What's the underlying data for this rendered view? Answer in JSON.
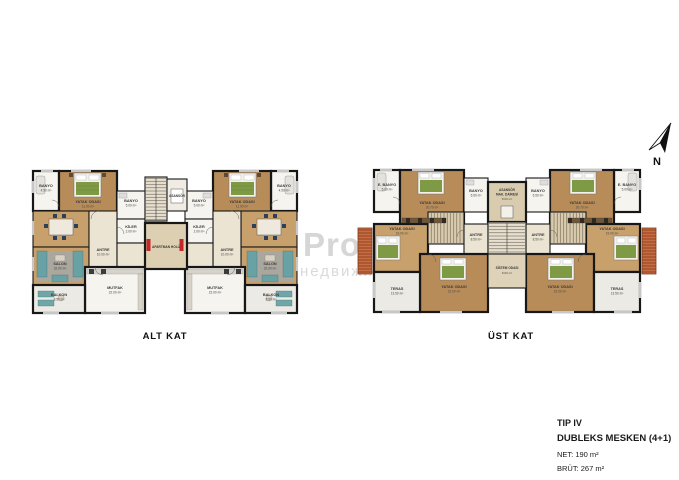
{
  "compass": {
    "label": "N"
  },
  "watermark": {
    "line1": "Pro",
    "line2": "недвижи"
  },
  "floors": {
    "alt": {
      "caption": "ALT KAT",
      "rooms": {
        "banyo_kucuk": {
          "name": "BANYO",
          "area": "4.50 m²"
        },
        "yatak": {
          "name": "YATAK ODASI",
          "area": "11.00 m²"
        },
        "banyo": {
          "name": "BANYO",
          "area": "5.00 m²"
        },
        "kiler": {
          "name": "KİLER",
          "area": "2.00 m²"
        },
        "antre": {
          "name": "ANTRE",
          "area": "10.00 m²"
        },
        "salon": {
          "name": "SALON",
          "area": "32.00 m²"
        },
        "mutfak": {
          "name": "MUTFAK",
          "area": "22.00 m²"
        },
        "balkon": {
          "name": "BALKON",
          "area": "8.50 m²"
        },
        "asansor": {
          "name": "ASANSÖR"
        },
        "hol": {
          "name": "APARTMAN HOLÜ"
        }
      }
    },
    "ust": {
      "caption": "ÜST KAT",
      "rooms": {
        "ebanyo": {
          "name": "E. BANYO",
          "area": "5.00 m²"
        },
        "yatak1": {
          "name": "YATAK ODASI",
          "area": "20.70 m²"
        },
        "banyo": {
          "name": "BANYO",
          "area": "6.50 m²"
        },
        "yatak2": {
          "name": "YATAK ODASI",
          "area": "19.00 m²"
        },
        "antre": {
          "name": "ANTRE",
          "area": "8.50 m²"
        },
        "yatak3": {
          "name": "YATAK ODASI",
          "area": "22.00 m²"
        },
        "teras": {
          "name": "TERAS",
          "area": "13.50 m²"
        },
        "asansor": {
          "name1": "ASANSÖR",
          "name2": "MAK. DAİRESİ",
          "area": "8.00 m²"
        },
        "sistem": {
          "name": "SİSTEM ODASI",
          "area": "8.00 m²"
        }
      }
    }
  },
  "info": {
    "tip": "TIP IV",
    "type": "DUBLEKS MESKEN (4+1)",
    "net": "NET: 190 m²",
    "brut": "BRÜT: 267 m²"
  }
}
